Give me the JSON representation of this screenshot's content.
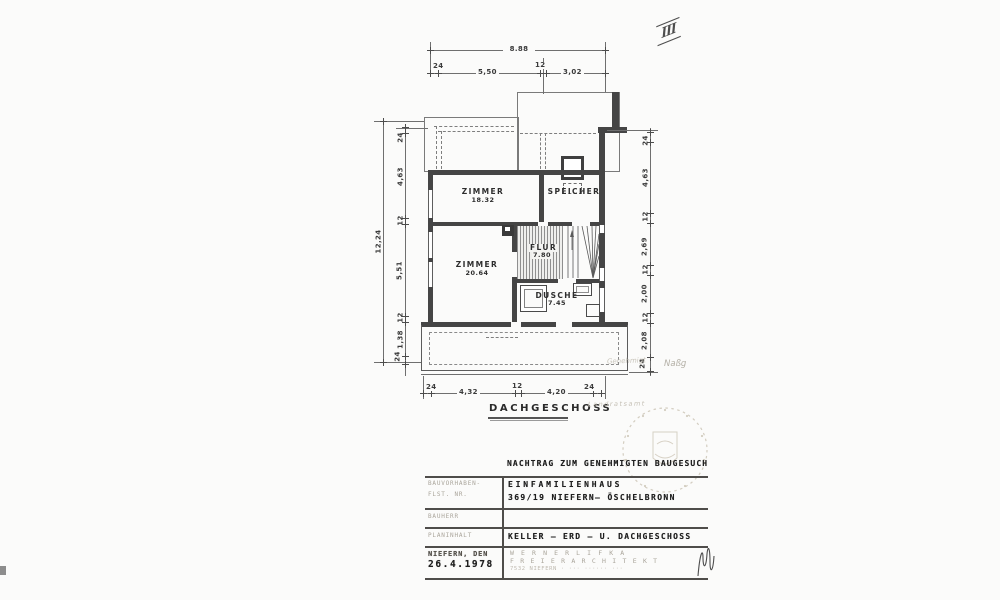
{
  "page": {
    "sheet_index": "III",
    "floor_label": "DACHGESCHOSS"
  },
  "plan": {
    "rooms": [
      {
        "name": "ZIMMER",
        "area": "18.32"
      },
      {
        "name": "SPEICHER",
        "area": ""
      },
      {
        "name": "ZIMMER",
        "area": "20.64"
      },
      {
        "name": "FLUR",
        "area": "7.80"
      },
      {
        "name": "DUSCHE",
        "area": "7.45"
      }
    ],
    "dimensions": {
      "top_overall": "8.88",
      "top_segments": [
        "24",
        "5,50",
        "12",
        "3,02"
      ],
      "left_overall": "12,24",
      "left_segments": [
        "24",
        "4,63",
        "12",
        "5,51",
        "12",
        "1,38",
        "24"
      ],
      "right_segments": [
        "24",
        "4,63",
        "12",
        "2,69",
        "12",
        "2,00",
        "12",
        "2,08",
        "24"
      ],
      "bottom_segments": [
        "24",
        "4,32",
        "12",
        "4,20",
        "24"
      ]
    }
  },
  "title_block": {
    "header": "NACHTRAG ZUM GENEHMIGTEN BAUGESUCH",
    "field_label_line1": "BAUVORHABEN-",
    "field_label_line2": "FLST. NR.",
    "project_line1": "EINFAMILIENHAUS",
    "project_line2": "369/19  NIEFERN– ÖSCHELBRONN",
    "field_label_row2": "BAUHERR",
    "field_label_row3": "PLANINHALT",
    "plan_content": "KELLER – ERD – U.  DACHGESCHOSS",
    "place_label": "NIEFERN, DEN",
    "date": "26.4.1978",
    "architect_name": "W E R N E R   L I F K A",
    "architect_title": "F R E I E R   A R C H I T E K T",
    "architect_address": "7532 NIEFERN · ··· ······ ···"
  },
  "annotations": {
    "pencil_note1": "Genehmigt",
    "pencil_note2": "Naßg",
    "pencil_note3": "Landratsamt"
  }
}
